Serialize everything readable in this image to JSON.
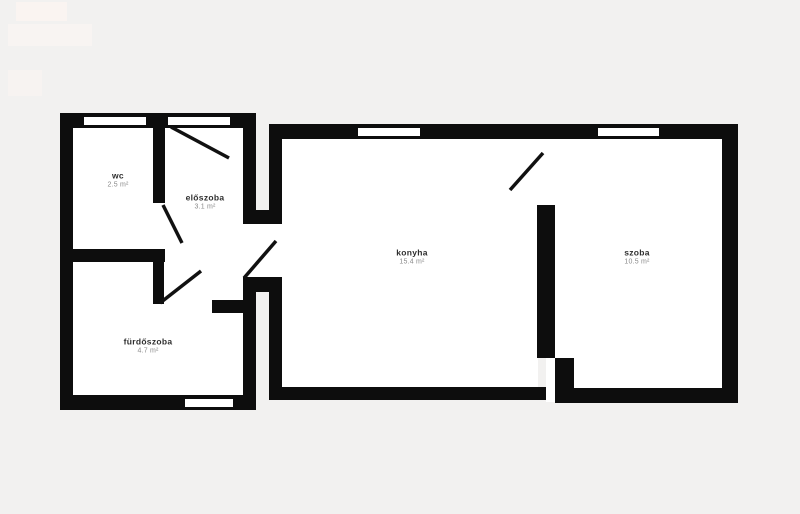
{
  "page": {
    "width": 800,
    "height": 514,
    "background": "#f2f1f0"
  },
  "palette": {
    "wall": "#0d0d0d",
    "room_fill": "#ffffff",
    "opening_fill": "#ffffff",
    "door_line": "#111111",
    "room_name_color": "#2e2e2e",
    "room_area_color": "#8a8a8a"
  },
  "rooms": [
    {
      "id": "wc",
      "name": "wc",
      "area": "2.5 m²",
      "cx": 118,
      "cy": 180
    },
    {
      "id": "eloszoba",
      "name": "előszoba",
      "area": "3.1 m²",
      "cx": 205,
      "cy": 202
    },
    {
      "id": "konyha",
      "name": "konyha",
      "area": "15.4 m²",
      "cx": 412,
      "cy": 257
    },
    {
      "id": "szoba",
      "name": "szoba",
      "area": "10.5 m²",
      "cx": 637,
      "cy": 257
    },
    {
      "id": "furdoszoba",
      "name": "fürdőszoba",
      "area": "4.7 m²",
      "cx": 148,
      "cy": 346
    }
  ],
  "floors": [
    {
      "name": "floor-left-section",
      "rect": [
        73,
        128,
        170,
        268
      ]
    },
    {
      "name": "floor-passage",
      "rect": [
        243,
        220,
        39,
        60
      ]
    },
    {
      "name": "floor-konyha",
      "rect": [
        282,
        138,
        256,
        250
      ]
    },
    {
      "name": "floor-divider-gap",
      "rect": [
        537,
        138,
        18,
        70
      ]
    },
    {
      "name": "floor-szoba",
      "rect": [
        555,
        138,
        167,
        251
      ]
    },
    {
      "name": "floor-bottom-slot",
      "rect": [
        546,
        356,
        12,
        46
      ]
    }
  ],
  "walls": [
    {
      "name": "wall-left-section-top",
      "rect": [
        60,
        113,
        196,
        15
      ]
    },
    {
      "name": "wall-left-section-left",
      "rect": [
        60,
        113,
        13,
        297
      ]
    },
    {
      "name": "wall-left-section-bottom",
      "rect": [
        60,
        395,
        196,
        15
      ]
    },
    {
      "name": "wall-left-section-right-upper",
      "rect": [
        243,
        113,
        13,
        111
      ]
    },
    {
      "name": "wall-left-section-right-lower",
      "rect": [
        243,
        277,
        13,
        133
      ]
    },
    {
      "name": "wall-wc-eloszoba-divider",
      "rect": [
        153,
        126,
        12,
        77
      ]
    },
    {
      "name": "wall-wc-furdoszoba",
      "rect": [
        60,
        249,
        105,
        13
      ]
    },
    {
      "name": "wall-furdoszoba-eloszoba-vertical",
      "rect": [
        153,
        249,
        11,
        55
      ]
    },
    {
      "name": "wall-eloszoba-bottom-stub",
      "rect": [
        212,
        300,
        34,
        13
      ]
    },
    {
      "name": "wall-neck-upper-connector",
      "rect": [
        243,
        210,
        39,
        14
      ]
    },
    {
      "name": "wall-neck-lower-connector",
      "rect": [
        243,
        277,
        39,
        15
      ]
    },
    {
      "name": "wall-main-top",
      "rect": [
        269,
        124,
        469,
        15
      ]
    },
    {
      "name": "wall-konyha-left-upper",
      "rect": [
        269,
        124,
        13,
        98
      ]
    },
    {
      "name": "wall-konyha-left-lower",
      "rect": [
        269,
        292,
        13,
        108
      ]
    },
    {
      "name": "wall-konyha-bottom",
      "rect": [
        269,
        387,
        277,
        13
      ]
    },
    {
      "name": "wall-konyha-szoba-divider",
      "rect": [
        537,
        205,
        18,
        153
      ]
    },
    {
      "name": "wall-szoba-bottom-stub",
      "rect": [
        555,
        358,
        19,
        33
      ]
    },
    {
      "name": "wall-szoba-bottom",
      "rect": [
        555,
        388,
        183,
        15
      ]
    },
    {
      "name": "wall-szoba-right",
      "rect": [
        722,
        124,
        16,
        279
      ]
    }
  ],
  "openings": [
    {
      "name": "window-wc-top",
      "rect": [
        84,
        117,
        62,
        8
      ]
    },
    {
      "name": "opening-entrance-top",
      "rect": [
        168,
        117,
        62,
        8
      ]
    },
    {
      "name": "window-furdoszoba-bottom",
      "rect": [
        185,
        399,
        48,
        8
      ]
    },
    {
      "name": "window-konyha-top",
      "rect": [
        358,
        128,
        62,
        8
      ]
    },
    {
      "name": "window-szoba-top",
      "rect": [
        598,
        128,
        61,
        8
      ]
    }
  ],
  "doors": [
    {
      "name": "door-swing-entrance",
      "line": [
        171,
        127,
        229,
        158
      ]
    },
    {
      "name": "door-swing-wc",
      "line": [
        163,
        205,
        182,
        243
      ]
    },
    {
      "name": "door-swing-furdoszoba",
      "line": [
        160,
        303,
        201,
        271
      ]
    },
    {
      "name": "door-swing-eloszoba-konyha",
      "line": [
        244,
        278,
        276,
        241
      ]
    },
    {
      "name": "door-swing-konyha-szoba",
      "line": [
        510,
        190,
        543,
        153
      ]
    }
  ],
  "watermark": [
    {
      "name": "watermark-block-1",
      "rect": [
        16,
        2,
        51,
        19
      ],
      "color": "#faf4f1"
    },
    {
      "name": "watermark-block-2",
      "rect": [
        8,
        24,
        84,
        22
      ],
      "color": "#f8f4f2"
    },
    {
      "name": "watermark-block-3",
      "rect": [
        8,
        70,
        34,
        26
      ],
      "color": "#f7f3f1"
    }
  ]
}
